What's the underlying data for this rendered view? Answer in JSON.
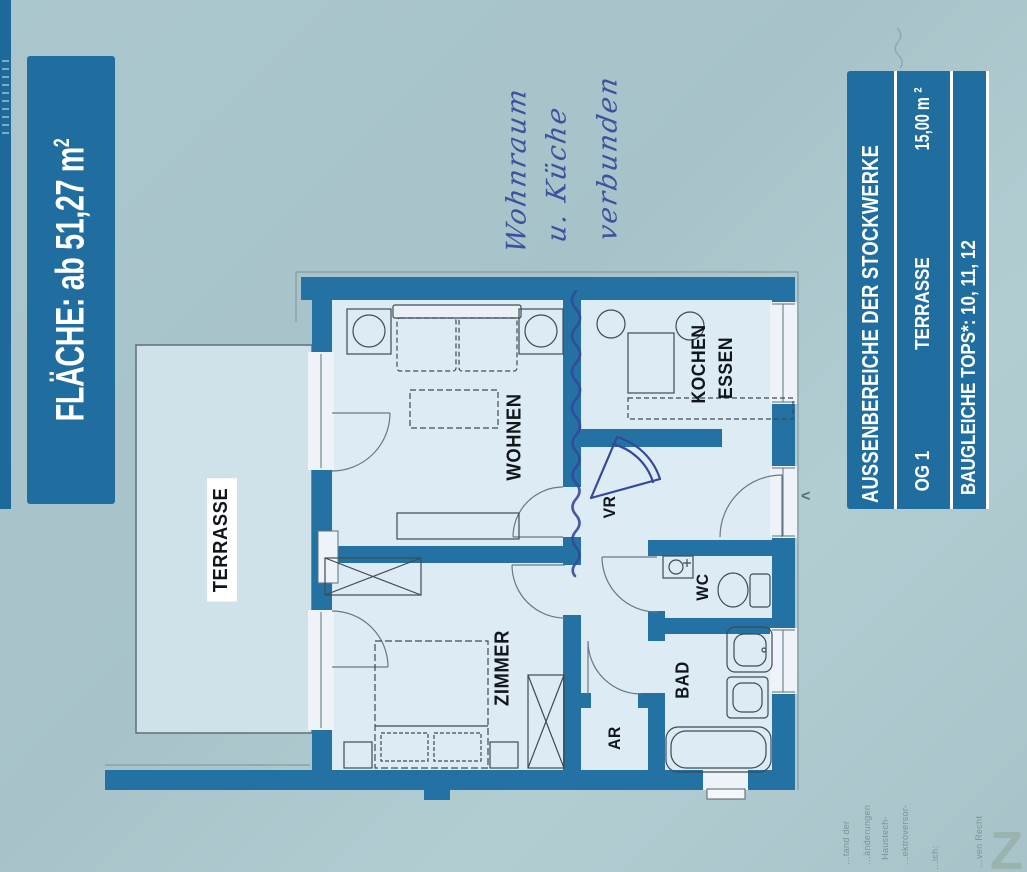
{
  "colors": {
    "background": "#a8c5cb",
    "banner_blue": "#1f6e9f",
    "wall_blue": "#2472a3",
    "room_fill": "#ddebf4",
    "terrace_fill": "#cfe1e9",
    "ink_blue": "#35489c"
  },
  "left_banner": {
    "label": "FLÄCHE: ab 51,27 m",
    "sup": "2"
  },
  "right_banner": {
    "title": "AUSSENBEREICHE DER STOCKWERKE",
    "row": {
      "floor": "OG 1",
      "space": "TERRASSE",
      "area": "15,00 m",
      "area_sup": "2"
    },
    "footer": "BAUGLEICHE TOPS*: 10, 11, 12"
  },
  "rooms": {
    "terrasse": "TERRASSE",
    "wohnen": "WOHNEN",
    "kochen": "KOCHEN",
    "essen": "ESSEN",
    "zimmer": "ZIMMER",
    "vr": "VR",
    "wc": "WC",
    "bad": "BAD",
    "ar": "AR"
  },
  "handwriting": {
    "line1": "Wohnraum",
    "line2": "u. Küche",
    "line3": "verbunden"
  },
  "marks": {
    "chevron": "<",
    "watermark": "Z"
  },
  "fine_print": {
    "l1": "…tand der",
    "l2": "…änderungen",
    "l3": "Haustech-",
    "l4": "…ektroversor-",
    "l5": "…ich:",
    "l6": "…ven Recht"
  }
}
